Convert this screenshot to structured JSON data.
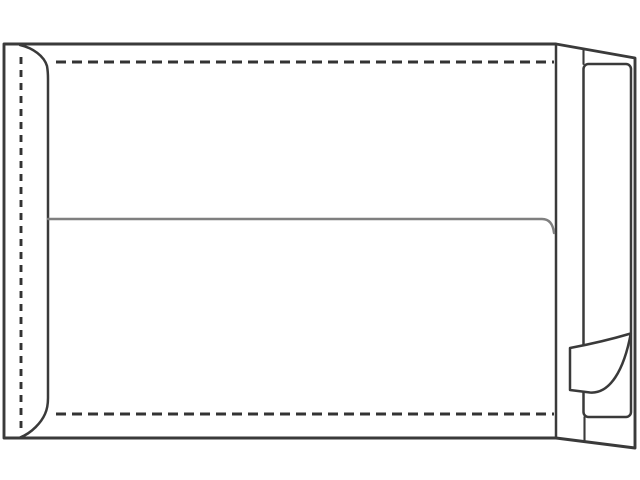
{
  "illustration": {
    "subject": "Blank pocket envelope shown from the back with side seam, dashed fold lines, center seam and a peel-and-seal strip whose release liner corner is peeled back",
    "background_color": "#ffffff",
    "outline_color": "#3a3a3a",
    "fold_dash_color": "#333333",
    "center_seam_color": "#7f7f7f",
    "parts": [
      {
        "name": "envelope-silhouette",
        "label": "Envelope body outline with right side panel"
      },
      {
        "name": "left-fold-dashed-line",
        "label": "Left seam fold line (dashed)"
      },
      {
        "name": "top-flap-dashed-line",
        "label": "Top flap fold line (dashed)"
      },
      {
        "name": "bottom-flap-dashed-line",
        "label": "Bottom flap fold line (dashed)"
      },
      {
        "name": "left-seam-edge-line",
        "label": "Glued left seam edge"
      },
      {
        "name": "center-seam-line",
        "label": "Horizontal center seam"
      },
      {
        "name": "right-fold-edge-line",
        "label": "Right fold edge"
      },
      {
        "name": "release-liner-strip",
        "label": "Peel-and-seal release liner strip"
      },
      {
        "name": "liner-peeled-corner",
        "label": "Peeled-back liner corner"
      }
    ]
  }
}
